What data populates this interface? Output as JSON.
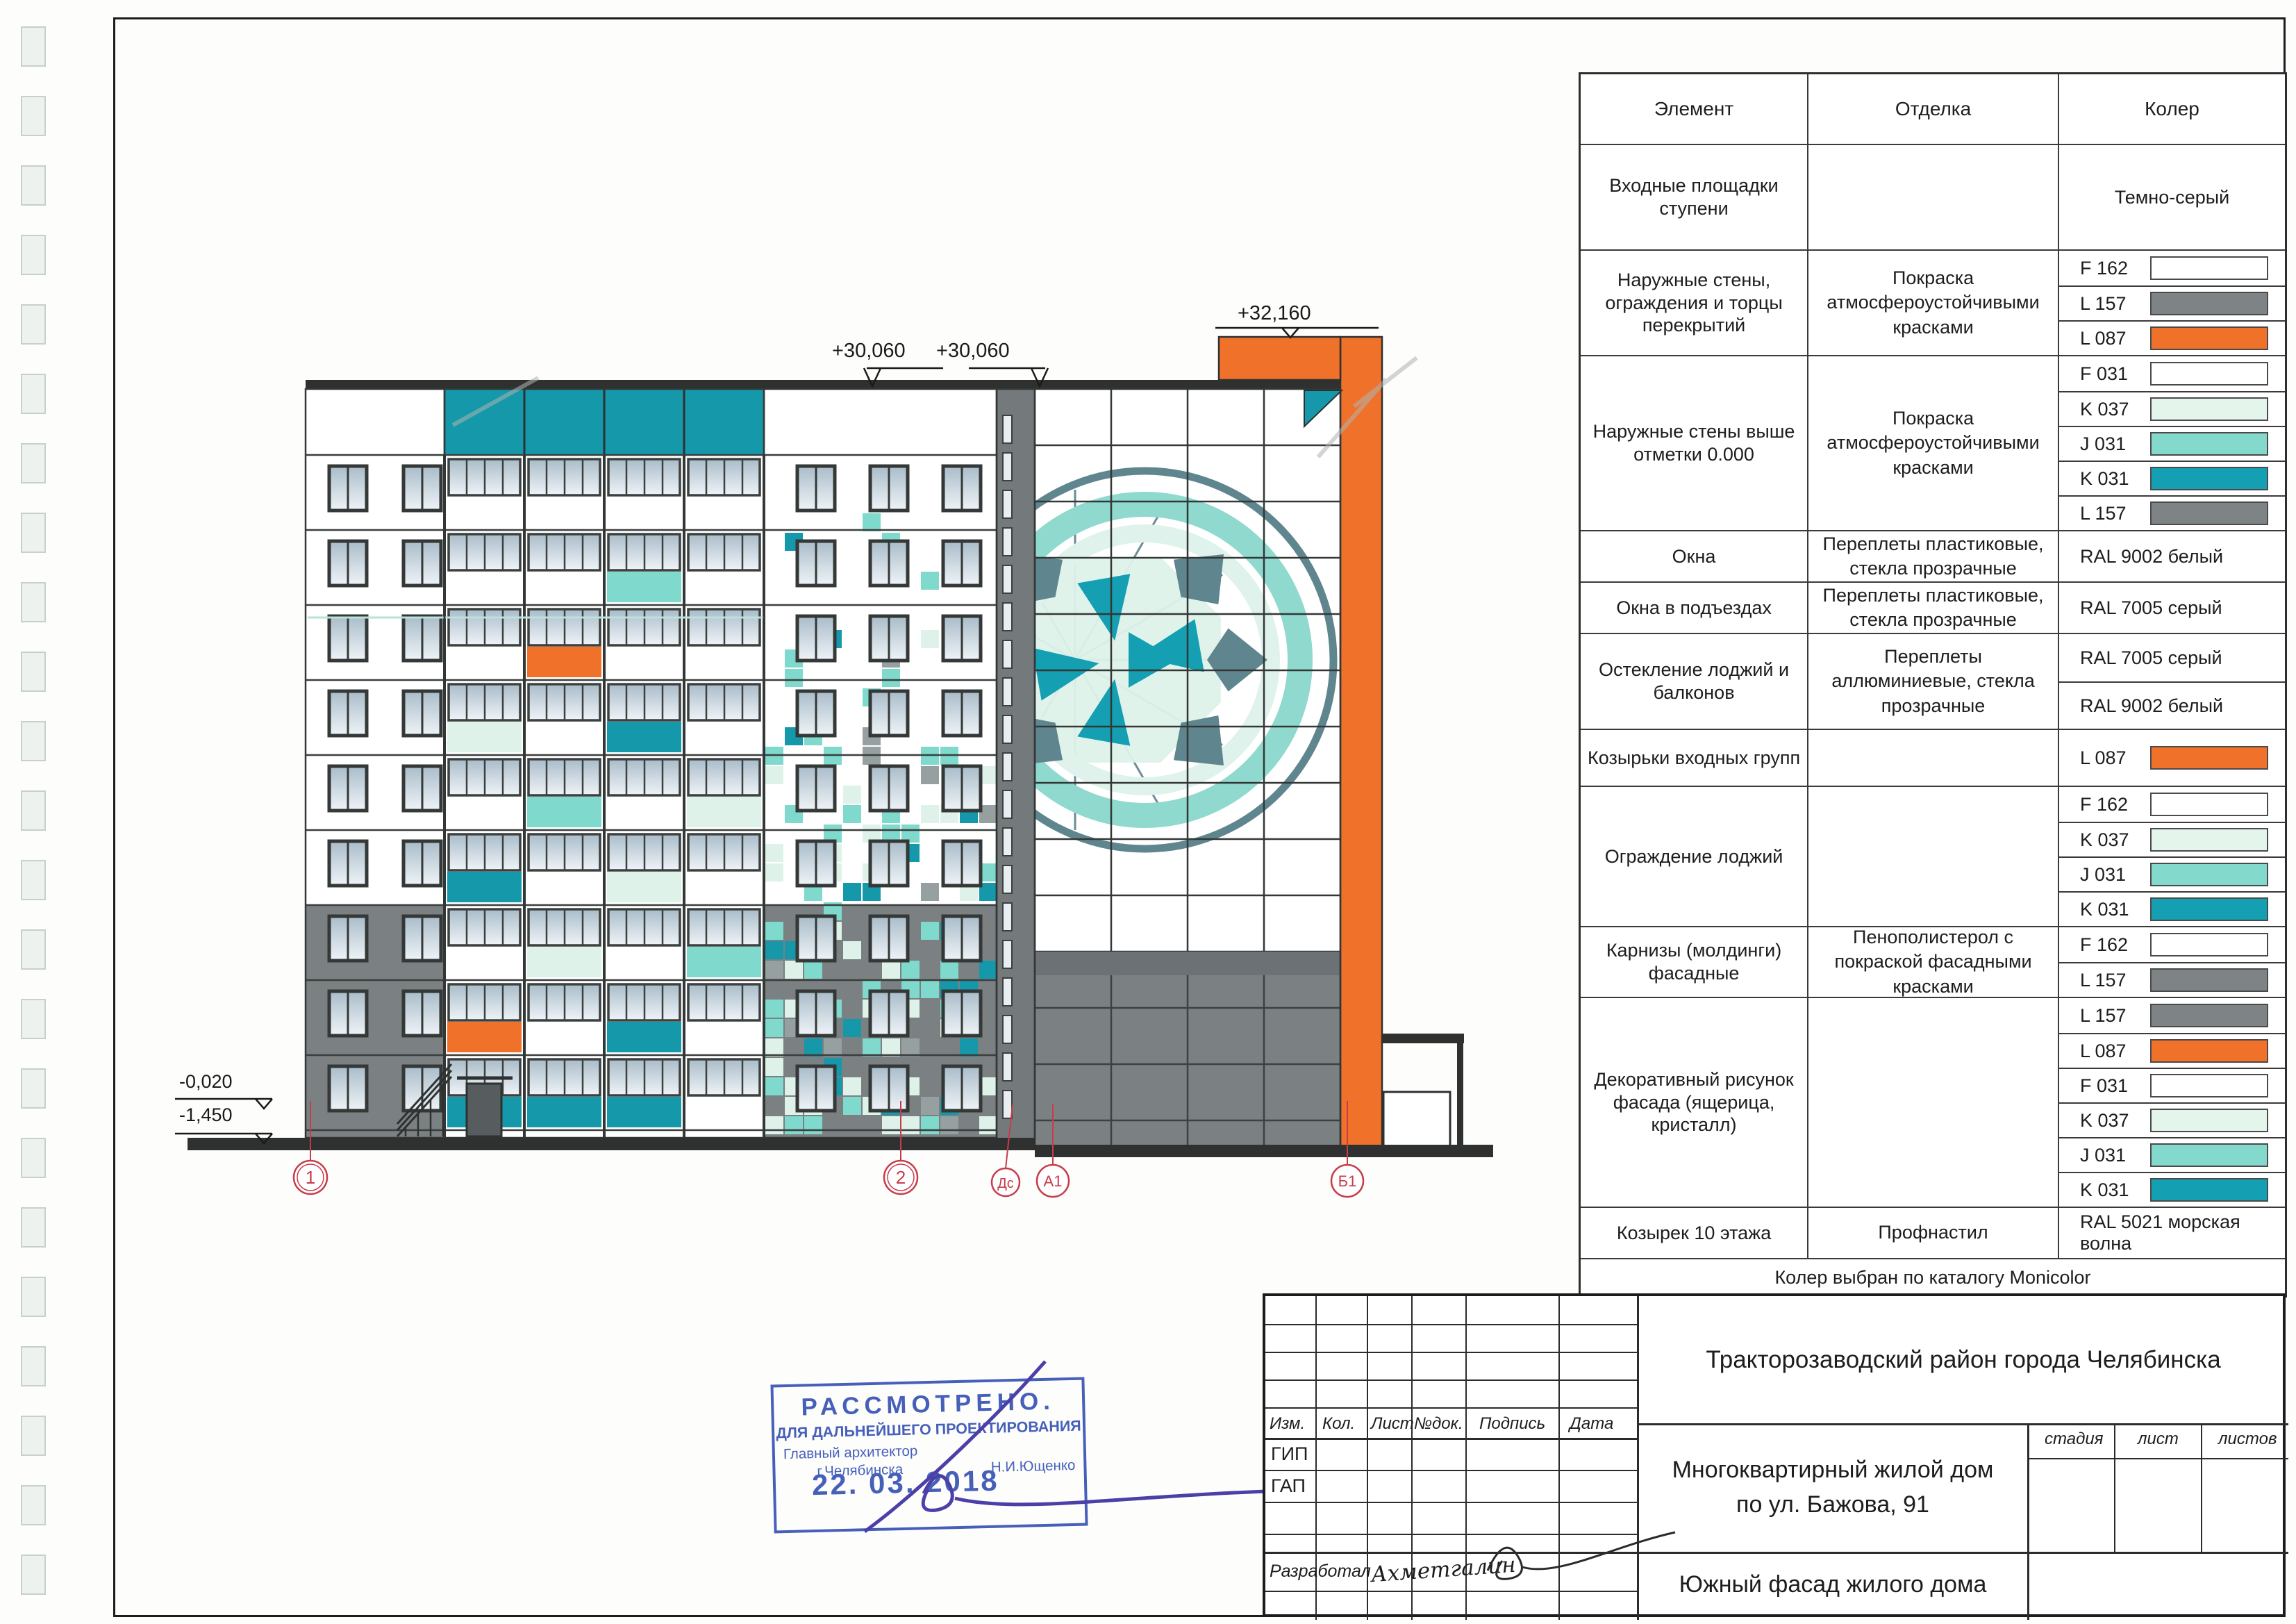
{
  "sheet": {
    "stamp": {
      "line1": "РАССМОТРЕНО.",
      "line2": "ДЛЯ ДАЛЬНЕЙШЕГО ПРОЕКТИРОВАНИЯ",
      "line3": "Главный архитектор",
      "city": "г.Челябинска",
      "name": "Н.И.Ющенко",
      "date": "22. 03. 2018"
    }
  },
  "finish_table": {
    "headers": [
      "Элемент",
      "Отделка",
      "Колер"
    ],
    "rows": [
      {
        "element": "Входные площадки ступени",
        "finish": "",
        "cells": [
          {
            "label": "Темно-серый"
          }
        ]
      },
      {
        "element": "Наружные стены, ограждения и торцы перекрытий",
        "finish": "Покраска атмосфероустойчивыми красками",
        "cells": [
          {
            "label": "F 162",
            "swatch": "#ffffff"
          },
          {
            "label": "L 157",
            "swatch": "#7e8486"
          },
          {
            "label": "L 087",
            "swatch": "#f0722a"
          }
        ]
      },
      {
        "element": "Наружные стены выше отметки 0.000",
        "finish": "Покраска атмосфероустойчивыми красками",
        "cells": [
          {
            "label": "F 031",
            "swatch": "#ffffff"
          },
          {
            "label": "K 037",
            "swatch": "#e4f5ec"
          },
          {
            "label": "J 031",
            "swatch": "#82d9cc"
          },
          {
            "label": "K 031",
            "swatch": "#14a0b2"
          },
          {
            "label": "L 157",
            "swatch": "#7e8486"
          }
        ]
      },
      {
        "element": "Окна",
        "finish": "Переплеты пластиковые, стекла прозрачные",
        "cells": [
          {
            "label": "RAL 9002 белый"
          }
        ]
      },
      {
        "element": "Окна в подъездах",
        "finish": "Переплеты пластиковые, стекла прозрачные",
        "cells": [
          {
            "label": "RAL 7005 серый"
          }
        ]
      },
      {
        "element": "Остекление лоджий и балконов",
        "finish": "Переплеты аллюминиевые, стекла прозрачные",
        "cells": [
          {
            "label": "RAL 7005 серый"
          },
          {
            "label": "RAL 9002 белый"
          }
        ]
      },
      {
        "element": "Козырьки входных групп",
        "finish": "",
        "cells": [
          {
            "label": "L 087",
            "swatch": "#f0722a"
          }
        ]
      },
      {
        "element": "Ограждение лоджий",
        "finish": "",
        "cells": [
          {
            "label": "F 162",
            "swatch": "#ffffff"
          },
          {
            "label": "K 037",
            "swatch": "#e4f5ec"
          },
          {
            "label": "J 031",
            "swatch": "#82d9cc"
          },
          {
            "label": "K 031",
            "swatch": "#14a0b2"
          }
        ]
      },
      {
        "element": "Карнизы (молдинги) фасадные",
        "finish": "Пенополистерол с покраской фасадными красками",
        "cells": [
          {
            "label": "F 162",
            "swatch": "#ffffff"
          },
          {
            "label": "L 157",
            "swatch": "#7e8486"
          }
        ]
      },
      {
        "element": "Декоративный рисунок фасада (ящерица, кристалл)",
        "finish": "",
        "cells": [
          {
            "label": "L 157",
            "swatch": "#7e8486"
          },
          {
            "label": "L 087",
            "swatch": "#f0722a"
          },
          {
            "label": "F 031",
            "swatch": "#ffffff"
          },
          {
            "label": "K 037",
            "swatch": "#e4f5ec"
          },
          {
            "label": "J 031",
            "swatch": "#82d9cc"
          },
          {
            "label": "K 031",
            "swatch": "#14a0b2"
          }
        ]
      },
      {
        "element": "Козырек 10 этажа",
        "finish": "Профнастил",
        "cells": [
          {
            "label": "RAL 5021 морская волна"
          }
        ]
      }
    ],
    "footer": "Колер выбран по каталогу Monicolor"
  },
  "title_block": {
    "district": "Тракторозаводский район города Челябинска",
    "object_line1": "Многоквартирный жилой дом",
    "object_line2": "по ул. Бажова, 91",
    "sheet_title": "Южный фасад жилого дома",
    "cols": [
      "Изм.",
      "Кол.",
      "Лист",
      "№док.",
      "Подпись",
      "Дата"
    ],
    "rows": [
      "ГИП",
      "ГАП"
    ],
    "developer_label": "Разработал",
    "developer_name": "Ахметгалин",
    "stage_cols": [
      "стадия",
      "лист",
      "листов"
    ]
  },
  "facade": {
    "levels": {
      "top": "+32,160",
      "roof": "+30,060",
      "zero": "-0,020",
      "ground": "-1,450"
    },
    "axes": [
      {
        "label": "1"
      },
      {
        "label": "2"
      },
      {
        "label": "Дс"
      },
      {
        "label": "А1"
      },
      {
        "label": "Б1"
      }
    ],
    "balcony_accents": [
      [
        2,
        3,
        "aqua"
      ],
      [
        3,
        2,
        "orange"
      ],
      [
        4,
        1,
        "mint"
      ],
      [
        4,
        3,
        "teal"
      ],
      [
        5,
        2,
        "aqua"
      ],
      [
        5,
        4,
        "mint"
      ],
      [
        6,
        1,
        "teal"
      ],
      [
        6,
        3,
        "mint"
      ],
      [
        7,
        2,
        "mint"
      ],
      [
        7,
        4,
        "aqua"
      ],
      [
        8,
        1,
        "orange"
      ],
      [
        8,
        3,
        "teal"
      ],
      [
        9,
        1,
        "teal"
      ],
      [
        9,
        2,
        "teal"
      ],
      [
        9,
        3,
        "teal"
      ]
    ],
    "colors": {
      "teal": "#1498aa",
      "aqua": "#7fd9cc",
      "mint": "#def2ea",
      "orange": "#f0722a",
      "wall_gray": "#7b8082",
      "core_gray": "#747a7c",
      "beam_gray": "#6b7174",
      "dark": "#2e3130",
      "frame": "#3c403e",
      "red": "#c83c4a",
      "emblem": "#5f868f",
      "stamp_blue": "#3753b5",
      "sign_violet": "#4b3fa8"
    }
  }
}
